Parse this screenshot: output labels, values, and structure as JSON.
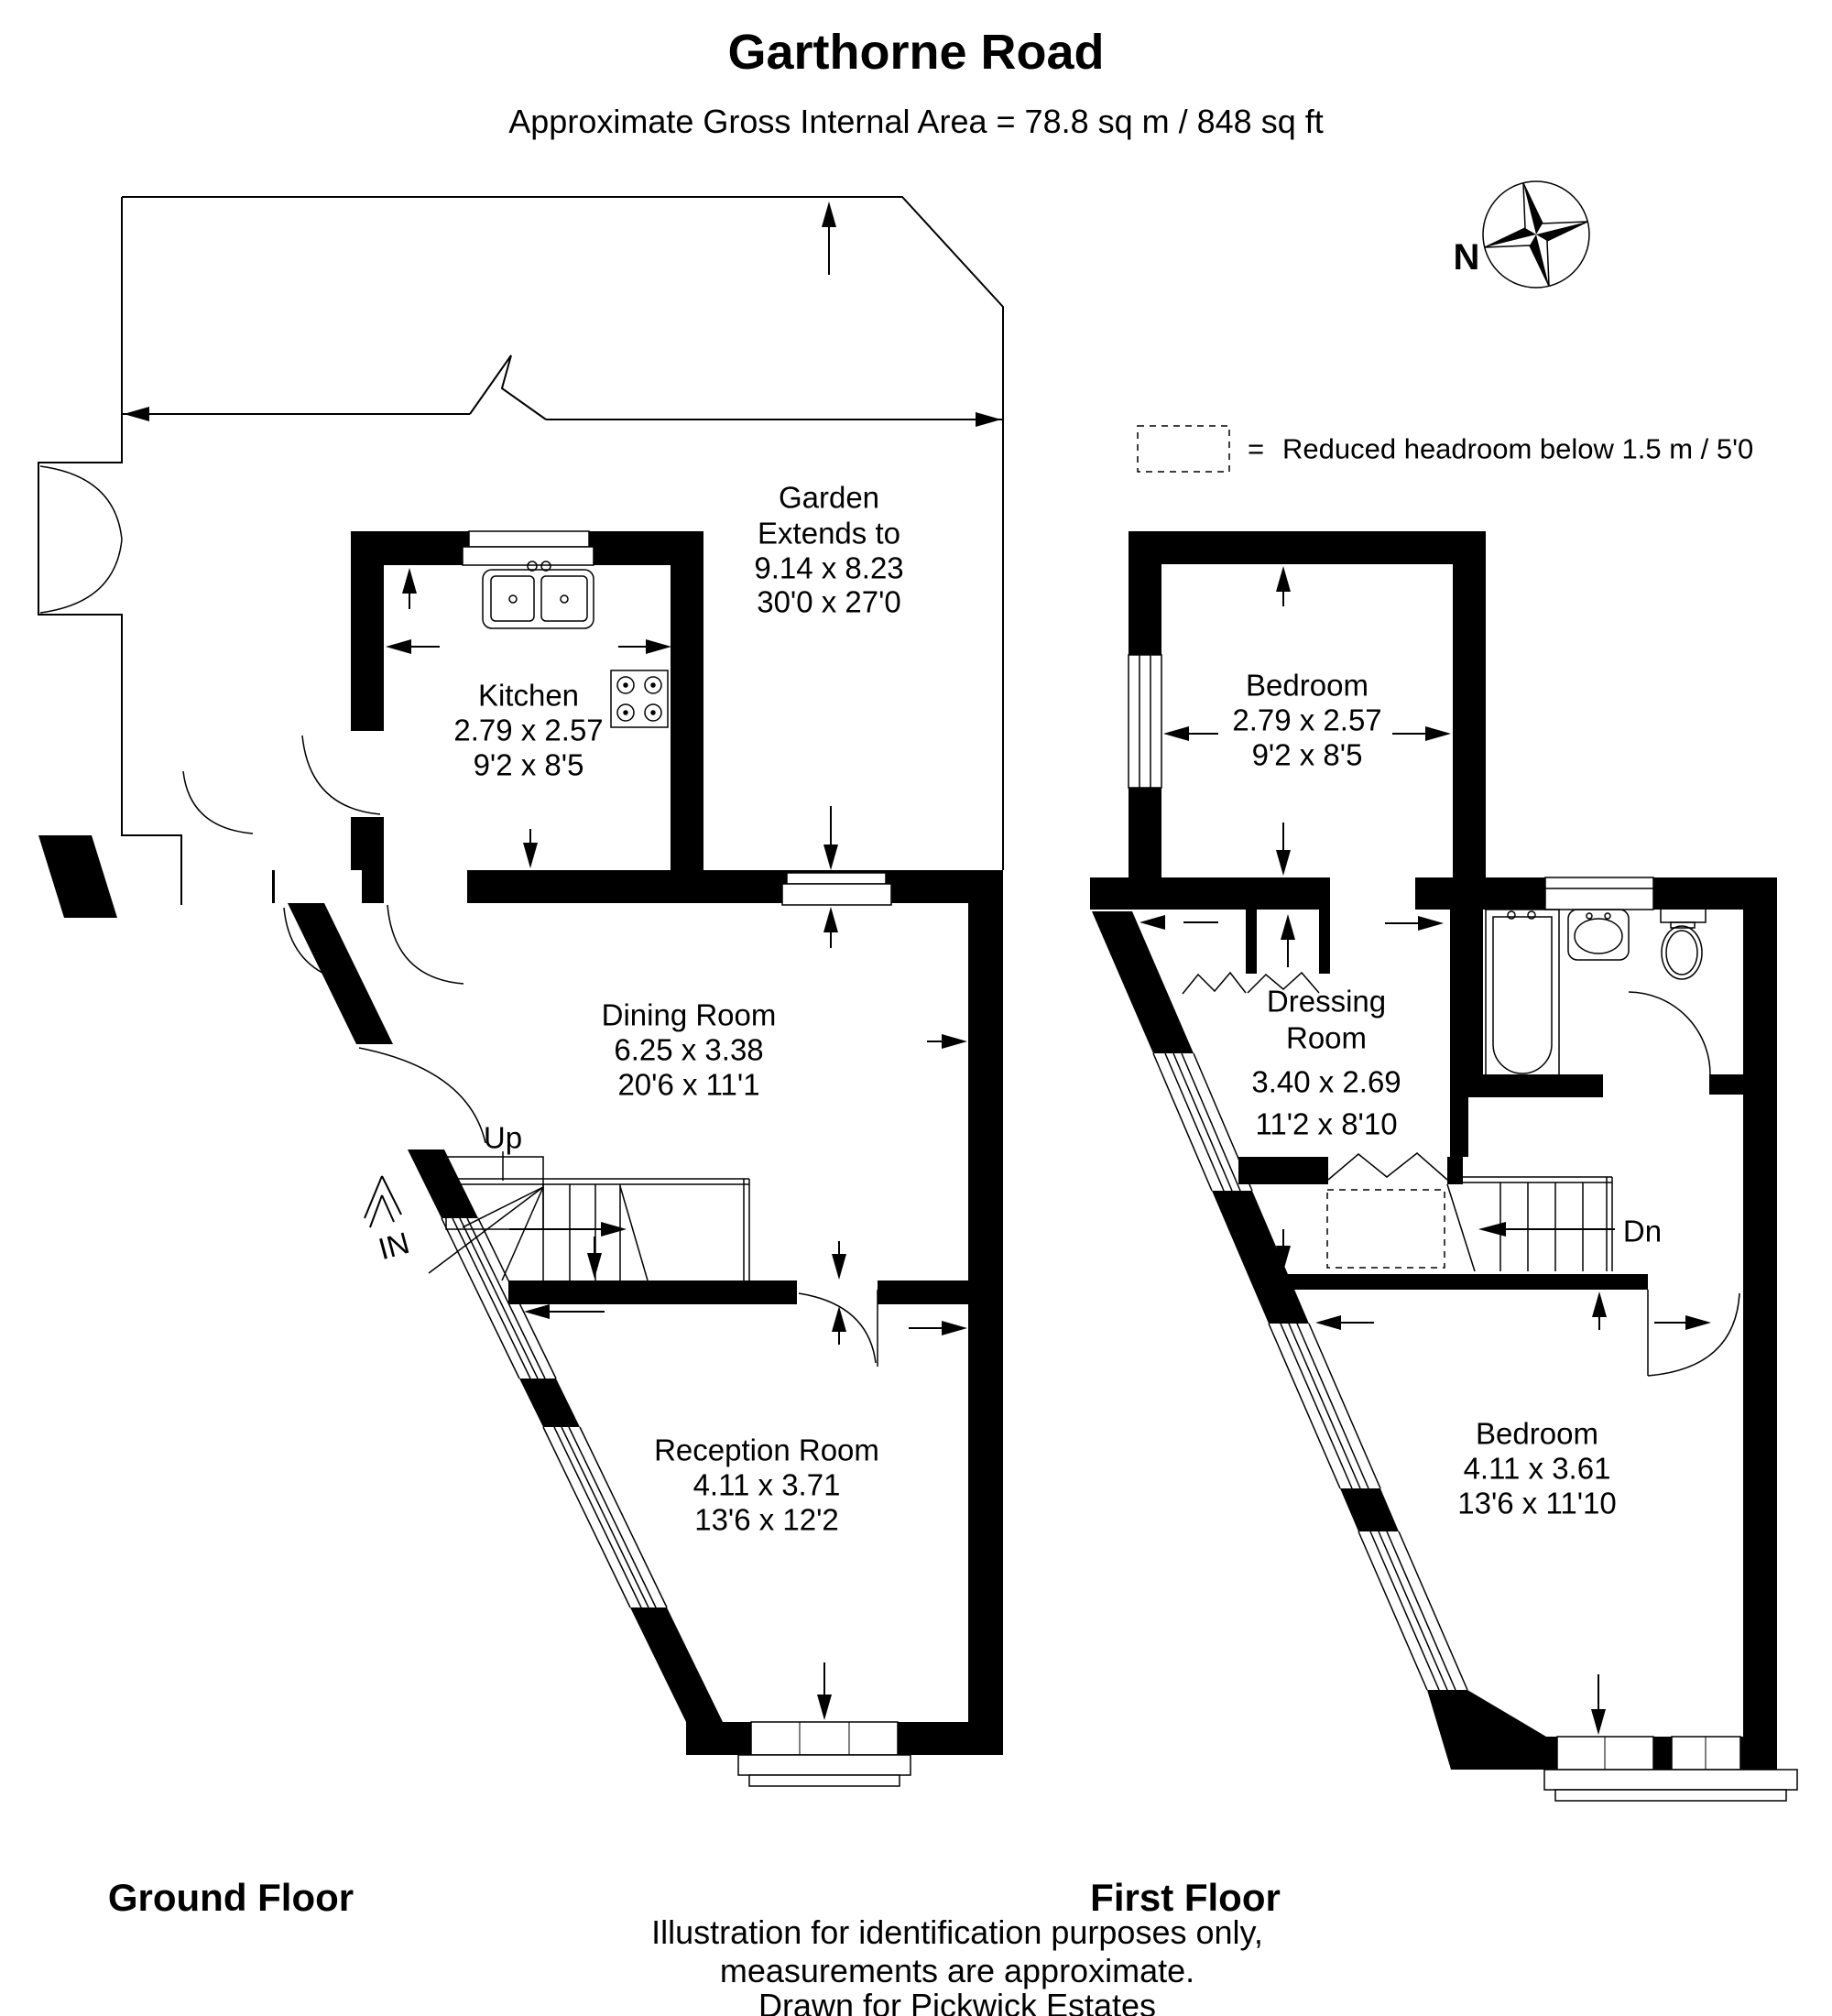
{
  "header": {
    "title": "Garthorne Road",
    "subtitle": "Approximate Gross Internal Area = 78.8 sq m / 848 sq ft"
  },
  "compass": {
    "label": "N"
  },
  "legend": {
    "equals": "=",
    "text": "Reduced headroom below 1.5 m / 5'0"
  },
  "ground_floor": {
    "label": "Ground Floor",
    "garden": {
      "name_line1": "Garden",
      "name_line2": "Extends to",
      "metric": "9.14 x 8.23",
      "imperial": "30'0 x 27'0"
    },
    "kitchen": {
      "name": "Kitchen",
      "metric": "2.79 x 2.57",
      "imperial": "9'2 x 8'5"
    },
    "dining_room": {
      "name": "Dining Room",
      "metric": "6.25 x 3.38",
      "imperial": "20'6 x 11'1"
    },
    "reception_room": {
      "name": "Reception Room",
      "metric": "4.11 x 3.71",
      "imperial": "13'6 x 12'2"
    },
    "stairs_label": "Up",
    "entrance_label": "IN"
  },
  "first_floor": {
    "label": "First Floor",
    "bedroom_top": {
      "name": "Bedroom",
      "metric": "2.79 x 2.57",
      "imperial": "9'2 x 8'5"
    },
    "dressing_room": {
      "name_line1": "Dressing",
      "name_line2": "Room",
      "metric": "3.40 x 2.69",
      "imperial": "11'2 x 8'10"
    },
    "bedroom_bottom": {
      "name": "Bedroom",
      "metric": "4.11 x 3.61",
      "imperial": "13'6 x 11'10"
    },
    "stairs_label": "Dn"
  },
  "footer": {
    "line1": "Illustration for identification purposes only,",
    "line2": "measurements are approximate.",
    "line3": "Drawn for Pickwick Estates"
  }
}
